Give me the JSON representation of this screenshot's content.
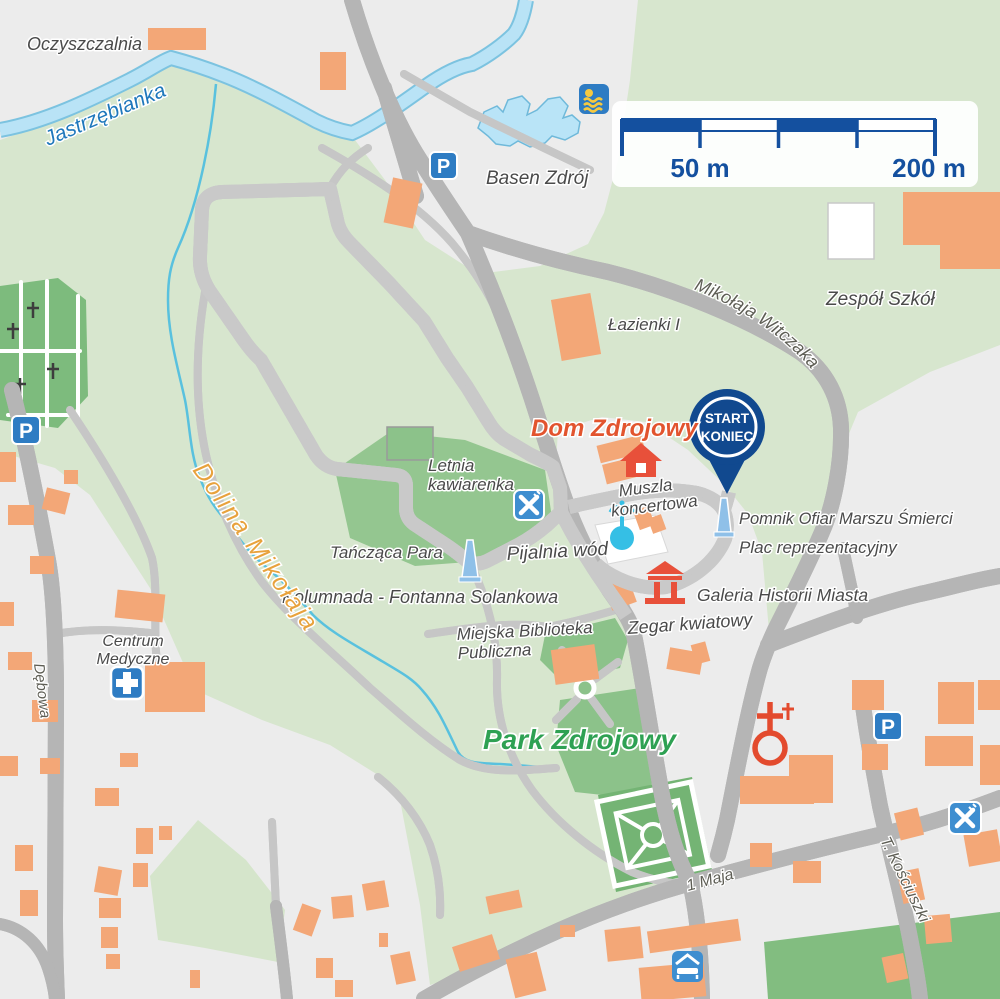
{
  "scale_bar": {
    "left": "50 m",
    "right": "200 m"
  },
  "marker": {
    "start": "START",
    "end": "KONIEC"
  },
  "icons": {
    "parking_letter": "P"
  },
  "labels": {
    "oczyszczalnia": "Oczyszczalnia",
    "jastrzebianka": "Jastrzębianka",
    "basen": "Basen Zdrój",
    "zespol": "Zespół Szkół",
    "lazienki": "Łazienki I",
    "witczaka": "Mikołaja Witczaka",
    "dom": "Dom Zdrojowy",
    "muszla1": "Muszla",
    "muszla2": "koncertowa",
    "pomnik": "Pomnik Ofiar Marszu Śmierci",
    "plac": "Plac reprezentacyjny",
    "galeria": "Galeria Historii Miasta",
    "zegar": "Zegar kwiatowy",
    "letnia1": "Letnia",
    "letnia2": "kawiarenka",
    "tanczaca": "Tańcząca Para",
    "pijalnia": "Pijalnia wód",
    "kolumnada": "Kolumnada - Fontanna Solankowa",
    "biblioteka1": "Miejska Biblioteka",
    "biblioteka2": "Publiczna",
    "park": "Park Zdrojowy",
    "dolina": "Dolina Mikołaja",
    "centrum1": "Centrum",
    "centrum2": "Medyczne",
    "debowa": "Dębowa",
    "maja": "1 Maja",
    "kosciuszki": "T. Kościuszki"
  },
  "colors": {
    "route": "#14509f",
    "water": "#b9e3f6",
    "green_base": "#d7e6ce",
    "lawn": "#8cc28a",
    "road": "#f8efc4",
    "building": "#f3a777",
    "label_orange": "#e2542e",
    "label_green": "#2ea153",
    "valley_label": "#e8a23c",
    "river_label": "#1f78bc"
  }
}
